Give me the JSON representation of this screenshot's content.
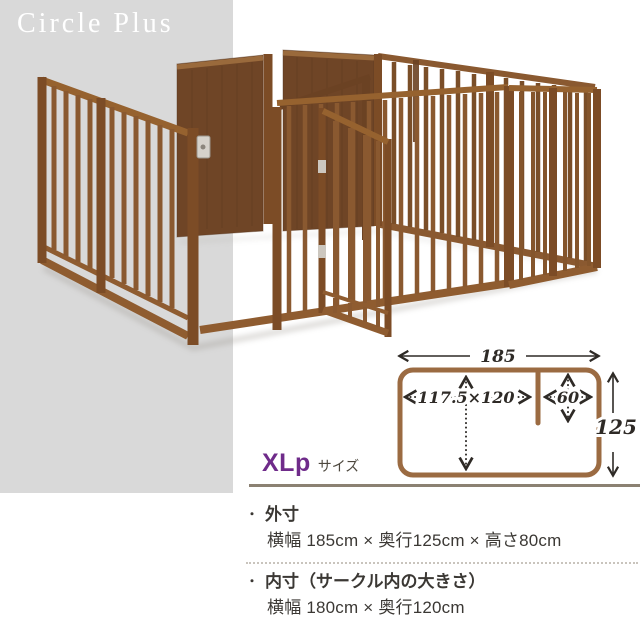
{
  "brand": {
    "title": "Circle Plus"
  },
  "diagram": {
    "outer_width": "185",
    "left_inner": "117.5×120",
    "right_inner": "60",
    "depth": "125"
  },
  "size": {
    "code": "XLp",
    "suffix": "サイズ"
  },
  "specs": {
    "bullet": "・",
    "outer_heading": "外寸",
    "outer_detail": "横幅 185cm × 奥行125cm × 高さ80cm",
    "inner_heading": "内寸（サークル内の大きさ）",
    "inner_detail": "横幅 180cm × 奥行120cm"
  },
  "colors": {
    "backdrop_gray": "#d9d9d9",
    "accent_purple": "#6f2b8a",
    "wood_brown": "#8a5930",
    "panel_brown": "#6f4526",
    "diagram_frame": "#9b6b42",
    "separator": "#8b8172",
    "text": "#3b3834"
  }
}
